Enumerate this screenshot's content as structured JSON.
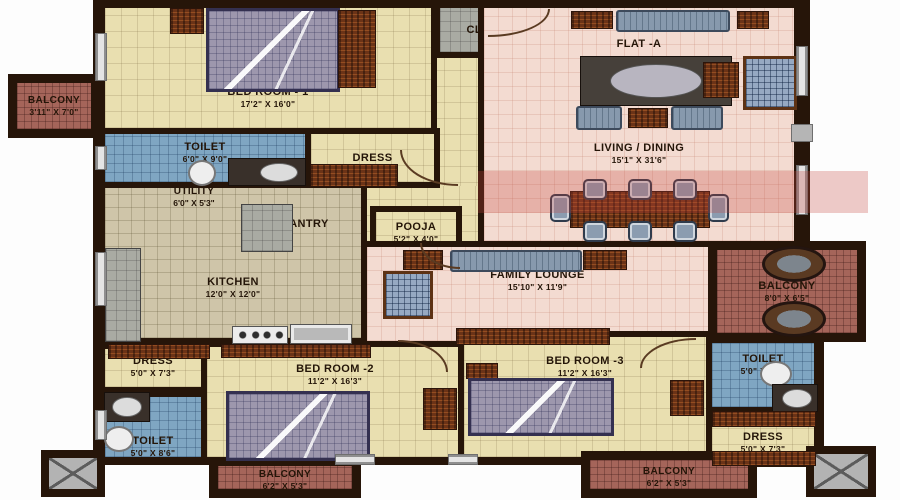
{
  "flat_label": "FLAT -A",
  "rooms": {
    "bedroom1": {
      "name": "BED ROOM - 1",
      "dims": "17'2\" X 16'0\""
    },
    "balcony_left": {
      "name": "BALCONY",
      "dims": "3'11\" X 7'0\""
    },
    "toilet1": {
      "name": "TOILET",
      "dims": "6'0\" X 9'0\""
    },
    "dress1": {
      "name": "DRESS",
      "dims": ""
    },
    "utility": {
      "name": "UTILITY",
      "dims": "6'0\" X 5'3\""
    },
    "pantry": {
      "name": "PANTRY",
      "dims": ""
    },
    "kitchen": {
      "name": "KITCHEN",
      "dims": "12'0\" X 12'0\""
    },
    "pooja": {
      "name": "POOJA",
      "dims": "5'2\" X 4'0\""
    },
    "closet": {
      "name": "CLOSET",
      "dims": ""
    },
    "living_dining": {
      "name": "LIVING / DINING",
      "dims": "15'1\" X 31'6\""
    },
    "family_lounge": {
      "name": "FAMILY LOUNGE",
      "dims": "15'10\" X 11'9\""
    },
    "balcony_right": {
      "name": "BALCONY",
      "dims": "8'0\" X 6'5\""
    },
    "dress2": {
      "name": "DRESS",
      "dims": "5'0\" X 7'3\""
    },
    "toilet2": {
      "name": "TOILET",
      "dims": "5'0\" X 8'6\""
    },
    "bedroom2": {
      "name": "BED ROOM -2",
      "dims": "11'2\" X 16'3\""
    },
    "balcony_bed2": {
      "name": "BALCONY",
      "dims": "6'2\" X 5'3\""
    },
    "bedroom3": {
      "name": "BED ROOM -3",
      "dims": "11'2\" X 16'3\""
    },
    "toilet3": {
      "name": "TOILET",
      "dims": "5'0\" X 8'6\""
    },
    "dress3": {
      "name": "DRESS",
      "dims": "5'0\" X 7'3\""
    },
    "balcony_bed3": {
      "name": "BALCONY",
      "dims": "6'2\" X 5'3\""
    }
  },
  "colors": {
    "wall": "#261509",
    "bedroom_floor": "#e9dfb0",
    "living_floor": "#f3dbd1",
    "toilet_floor": "#7fa6c2",
    "kitchen_floor": "#cfc5a9",
    "balcony_floor": "#a5655a",
    "closet_floor": "#a9aba3",
    "wood_furniture": "#6b3317",
    "watermark_red": "#c6463c"
  }
}
